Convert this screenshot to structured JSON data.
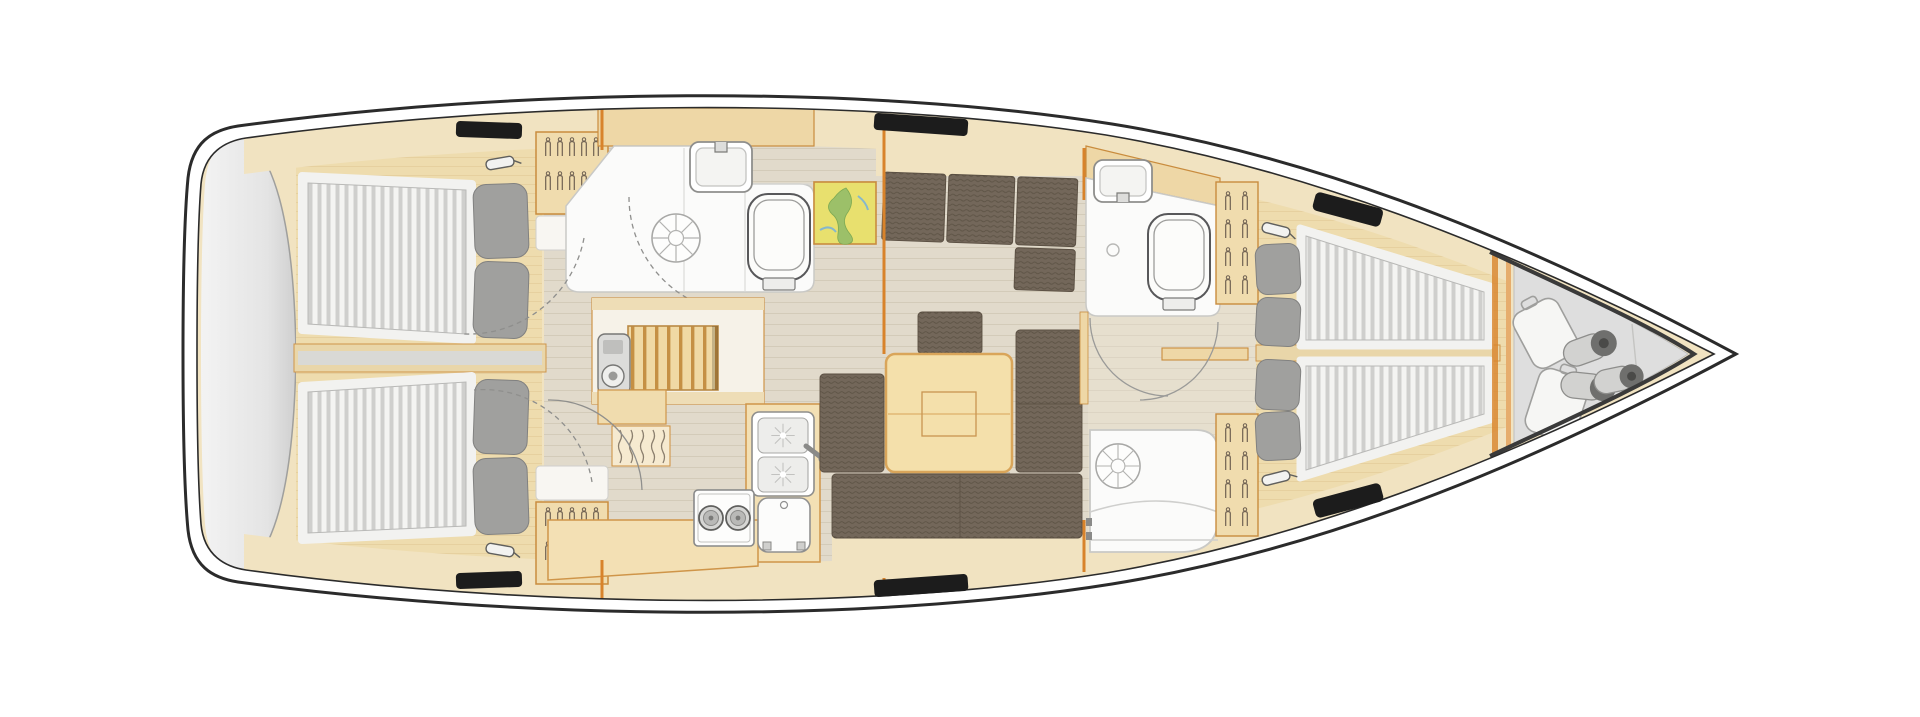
{
  "diagram": {
    "type": "sailing-yacht-interior-floor-plan",
    "orientation": {
      "bow": "right",
      "stern": "left"
    },
    "rooms": [
      {
        "name": "stern swim platform and transom locker",
        "features": [
          "grey storage area"
        ]
      },
      {
        "name": "aft cabin port",
        "features": [
          "double berth with striped mattress",
          "two grey pillows",
          "reading light",
          "wardrobe with hangers",
          "shelf locker"
        ]
      },
      {
        "name": "aft cabin starboard",
        "features": [
          "double berth with striped mattress",
          "two grey pillows",
          "reading light",
          "wardrobe with hangers",
          "shelf locker"
        ]
      },
      {
        "name": "aft head with shower",
        "features": [
          "shower drain",
          "washbasin with faucet",
          "toilet",
          "vanity counter",
          "dashed door swing"
        ]
      },
      {
        "name": "companionway",
        "features": [
          "entry steps",
          "engine instrument panel"
        ]
      },
      {
        "name": "galley",
        "features": [
          "double sink with faucet",
          "two burner stove",
          "fridge",
          "bottle rack",
          "L shaped counter",
          "storage cabinet"
        ]
      },
      {
        "name": "saloon",
        "features": [
          "L shaped sofa",
          "chaise cushion",
          "stool",
          "folding dining table",
          "U shaped sofa"
        ]
      },
      {
        "name": "chart table",
        "features": [
          "nautical chart"
        ]
      },
      {
        "name": "forward head",
        "features": [
          "washbasin",
          "toilet",
          "floor drain",
          "door swing"
        ]
      },
      {
        "name": "forward shower stall",
        "features": [
          "shower drain",
          "bench",
          "curved glass front"
        ]
      },
      {
        "name": "forward cabin",
        "features": [
          "twin V berths with striped mattresses",
          "four grey pillows",
          "two reading lights",
          "two hanging lockers",
          "centerline divider"
        ]
      },
      {
        "name": "anchor and sail locker",
        "features": [
          "two sail bags",
          "three rolled fenders",
          "collision bulkhead"
        ]
      }
    ],
    "icons": [
      "hanger-icon",
      "shower-drain-icon",
      "toilet-icon",
      "washbasin-icon",
      "stove-burner-icon",
      "fridge-icon",
      "reading-light-icon",
      "deck-hatch-icon",
      "door-swing-icon"
    ],
    "colors": {
      "hull_outline": "#2b2b2b",
      "deck_lining": "#f1e3c1",
      "oak_wood": "#eedcae",
      "wood_trim": "#cf9549",
      "bulkhead_orange": "#d8832b",
      "floor": "#e1dacb",
      "upholstery_brown": "#73675a",
      "pillow_grey": "#a0a09e",
      "mattress_white": "#f4f4f2",
      "mattress_stripe": "#cfcfcd",
      "fixture_white": "#fbfbfa",
      "stern_grey": "#dedede",
      "hatch_black": "#1c1c1c",
      "map_yellow": "#e8e06e",
      "map_green": "#9cc069"
    }
  }
}
